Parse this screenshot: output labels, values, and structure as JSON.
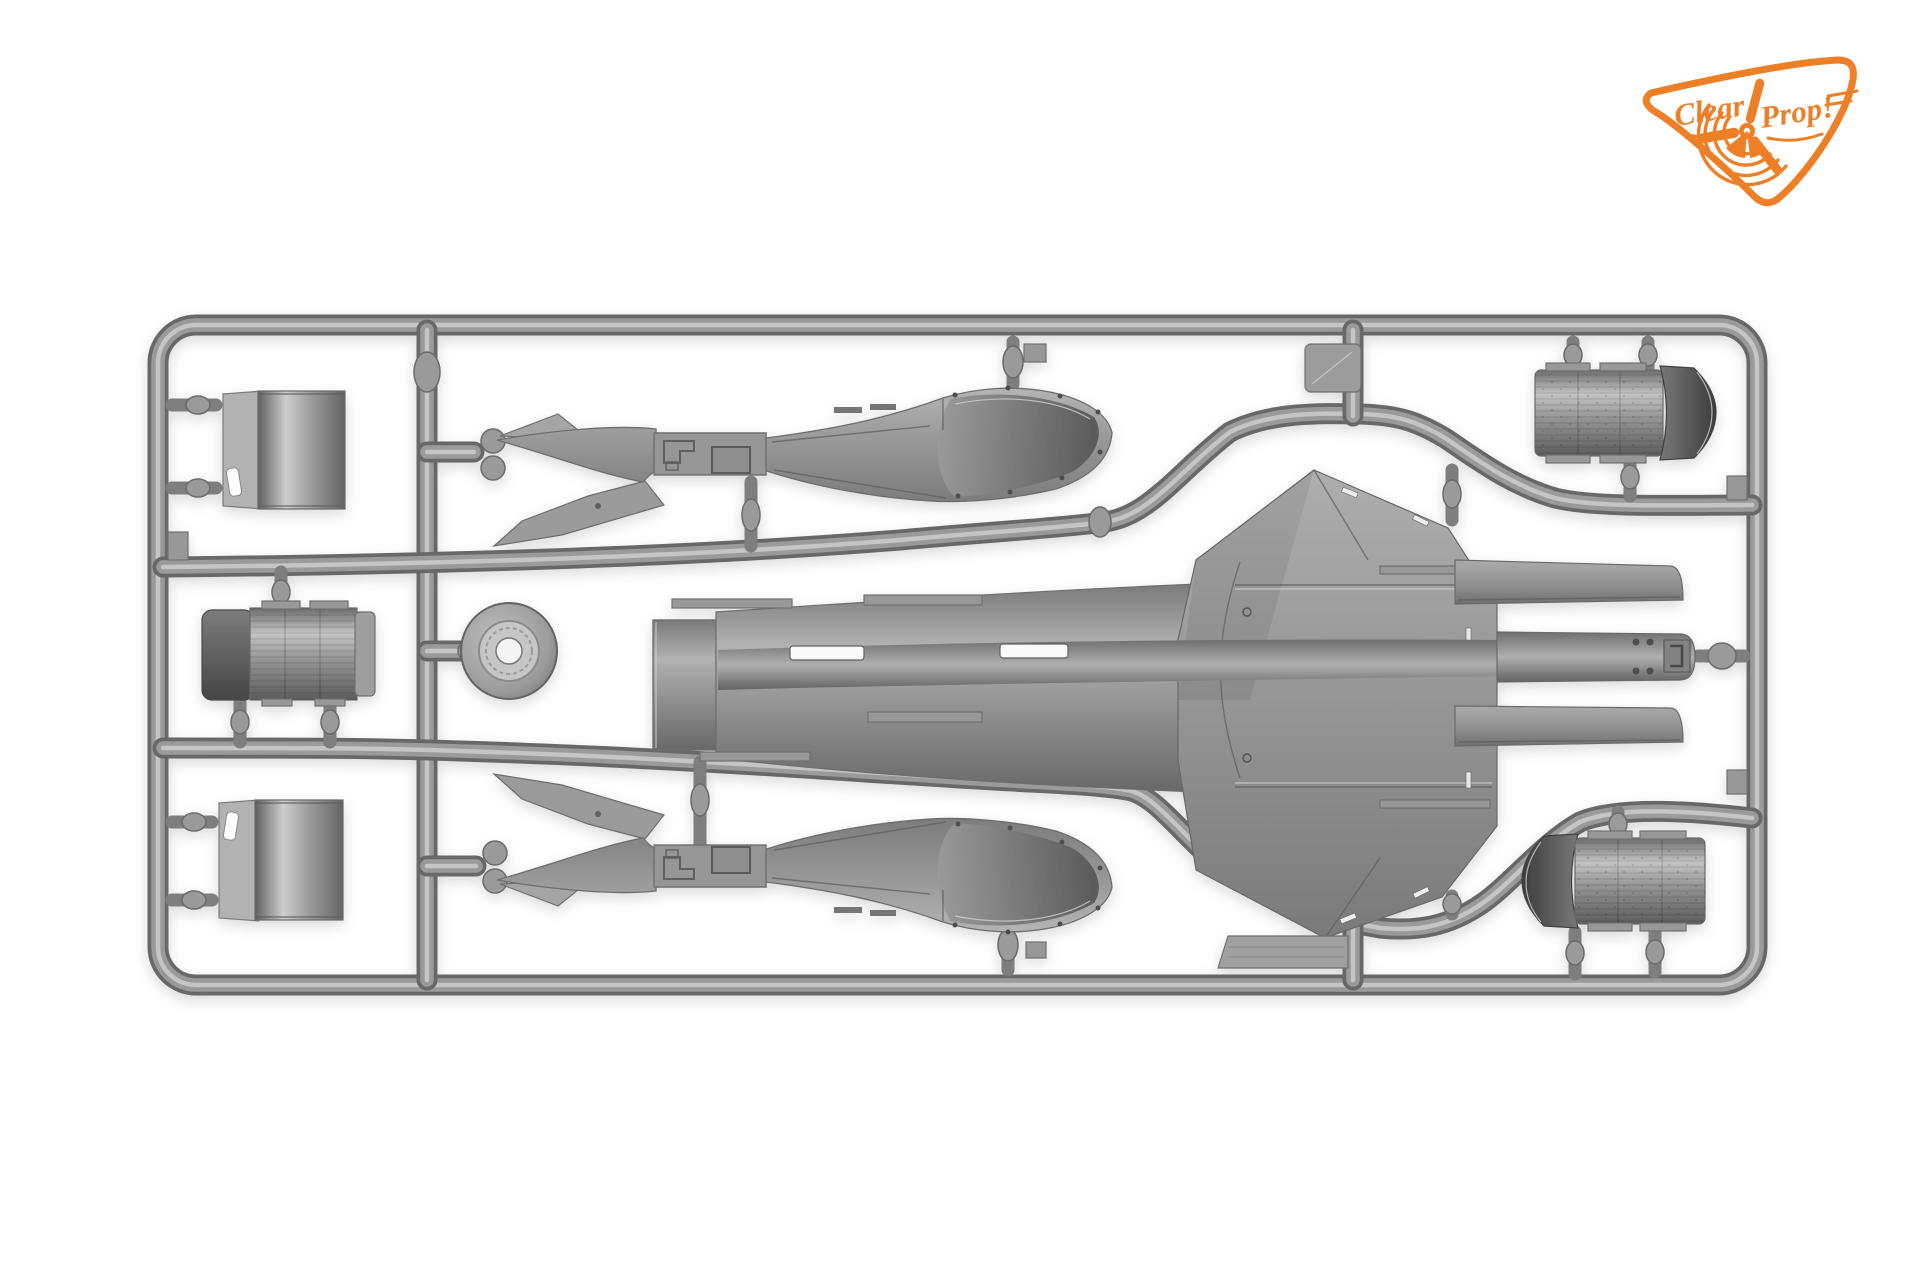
{
  "meta": {
    "description": "Product photograph of a gray injection-moulded plastic model kit sprue (parts runner frame) on a seamless white studio background",
    "background_color": "#ffffff"
  },
  "logo": {
    "name": "Clear Prop! brand badge",
    "word1": "Clear",
    "word2": "Prop!",
    "color": "#ed7f26",
    "icon": "propeller-badge-icon",
    "position": "top-right"
  },
  "sprue": {
    "material": "injection-moulded polystyrene",
    "plastic_colors": {
      "base": "#9a9a9a",
      "highlight": "#c9c9c9",
      "shadow": "#686868",
      "dark_detail": "#3e3e3e"
    },
    "frame": {
      "shape": "rounded-rectangle",
      "style": "cylindrical runners with gates to parts"
    },
    "parts": [
      {
        "id": "cowl-panel-upper-left",
        "label": "curved cowl/shroud panel with side flange and slot"
      },
      {
        "id": "engine-cylinder-left",
        "label": "ribbed cylindrical can with dark end cap"
      },
      {
        "id": "cowl-panel-lower-left",
        "label": "curved cowl/shroud panel with side flange and slot (mirrored)"
      },
      {
        "id": "nozzle-disc",
        "label": "round disc with raised ring and centre hole"
      },
      {
        "id": "fuselage-half-upper",
        "label": "slender fuselage half, interior side up, tail fins left, round nose right, cockpit recess"
      },
      {
        "id": "fuselage-half-lower",
        "label": "slender fuselage half, interior side up (mirror of upper)"
      },
      {
        "id": "centre-body-delta-wing",
        "label": "large centre body: open tube mouth, long spined fuselage, faceted delta wing section, twin rectangular booms and central tail boom"
      },
      {
        "id": "booster-drum-upper-right",
        "label": "finely ribbed booster drum with dark curved shroud on right end"
      },
      {
        "id": "booster-drum-lower-right",
        "label": "finely ribbed booster drum with dark curved shroud on left end (mirrored)"
      },
      {
        "id": "small-rect-tab-top",
        "label": "small rectangular moulding tab"
      },
      {
        "id": "flat-rect-panel-bottom",
        "label": "flat rectangular panel"
      },
      {
        "id": "frame-ejector-tabs",
        "label": "three small flat tabs on inner frame edges"
      }
    ]
  }
}
